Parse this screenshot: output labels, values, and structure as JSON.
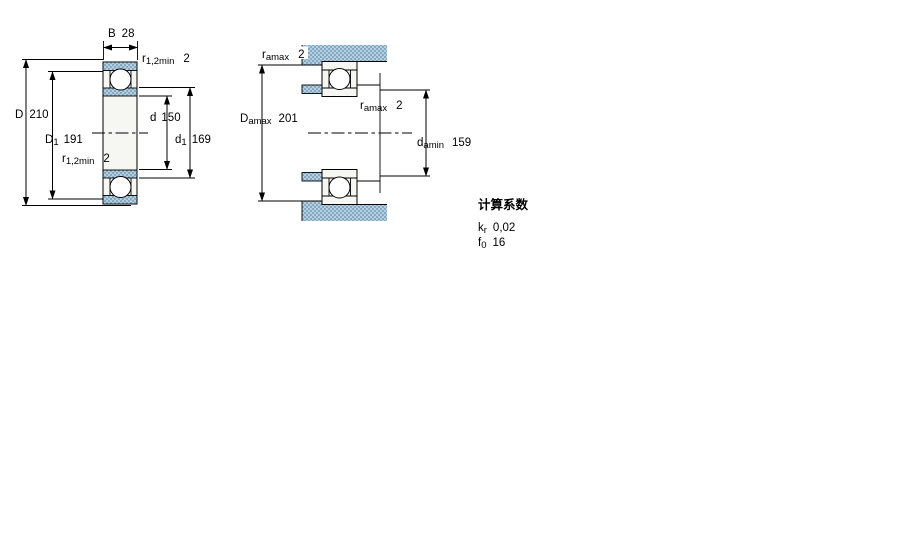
{
  "canvas": {
    "width": 900,
    "height": 560,
    "background": "#ffffff"
  },
  "colors": {
    "line": "#000000",
    "text": "#000000",
    "hatch_light": "#b3d0e0",
    "hatch_dark": "#88a8c2",
    "section_fill": "#f6f6f2",
    "background": "#ffffff"
  },
  "left_view": {
    "description": "bearing-cross-section",
    "dims": {
      "B": {
        "sym": "B",
        "sub": "",
        "val": "28"
      },
      "r_top": {
        "sym": "r",
        "sub": "1,2min",
        "val": "2"
      },
      "D": {
        "sym": "D",
        "sub": "",
        "val": "210"
      },
      "D1": {
        "sym": "D",
        "sub": "1",
        "val": "191"
      },
      "d": {
        "sym": "d",
        "sub": "",
        "val": "150"
      },
      "d1": {
        "sym": "d",
        "sub": "1",
        "val": "169"
      },
      "r_bot": {
        "sym": "r",
        "sub": "1,2min",
        "val": "2"
      }
    }
  },
  "right_view": {
    "description": "abutment-and-fillet-dimensions",
    "dims": {
      "ra_top": {
        "sym": "r",
        "sub": "amax",
        "val": "2"
      },
      "Da": {
        "sym": "D",
        "sub": "amax",
        "val": "201"
      },
      "ra_mid": {
        "sym": "r",
        "sub": "amax",
        "val": "2"
      },
      "da": {
        "sym": "d",
        "sub": "amin",
        "val": "159"
      }
    }
  },
  "calculation_factors": {
    "title": "计算系数",
    "rows": [
      {
        "sym": "k",
        "sub": "r",
        "val": "0,02"
      },
      {
        "sym": "f",
        "sub": "0",
        "val": "16"
      }
    ]
  }
}
